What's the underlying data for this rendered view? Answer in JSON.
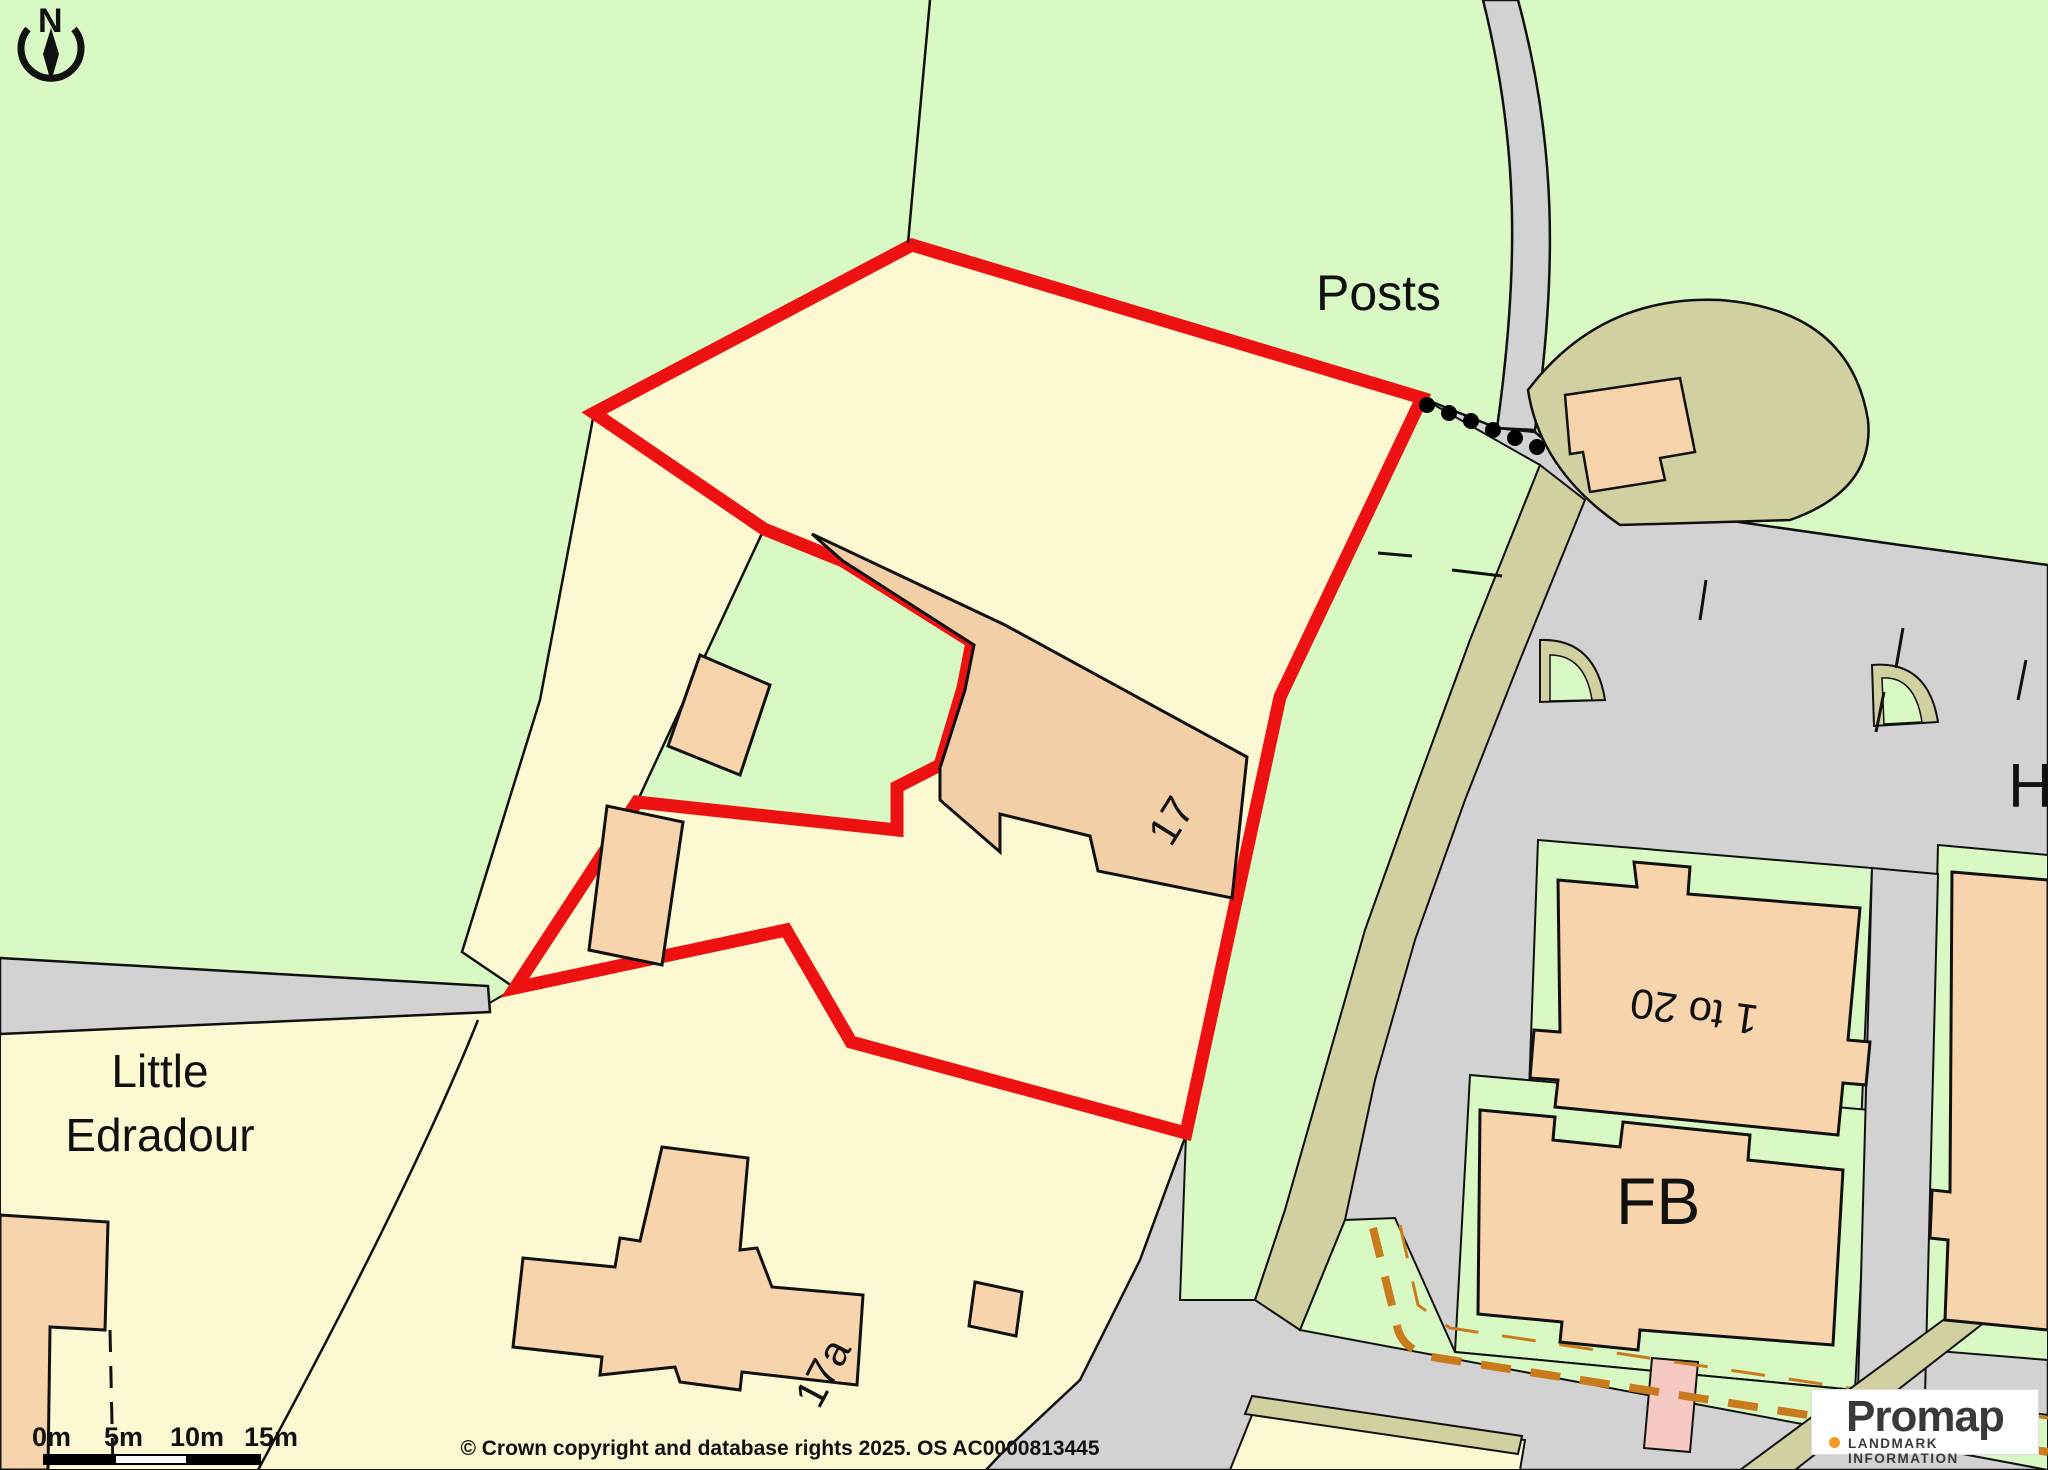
{
  "map": {
    "labels": {
      "posts": "Posts",
      "house_17": "17",
      "house_17a": "17a",
      "flats_range": "1 to 20",
      "fb": "FB",
      "street_partial": "H",
      "area_line1": "Little",
      "area_line2": "Edradour"
    },
    "compass": {
      "north": "N"
    },
    "scale_bar": {
      "ticks": [
        "0m",
        "5m",
        "10m",
        "15m"
      ]
    },
    "copyright": "© Crown copyright and database rights 2025. OS AC0000813445",
    "logo": {
      "brand": "Promap",
      "tagline": "LANDMARK INFORMATION"
    },
    "colors": {
      "field_green": "#d9f9c4",
      "parcel_yellow": "#fcf9d2",
      "building_peach": "#f7d4ab",
      "building_tan": "#f2cfa6",
      "verge_khaki": "#d0d0a0",
      "road_grey": "#d2d2d2",
      "boundary_red": "#ee1111",
      "path_pink": "#f7c9c3",
      "dash_orange": "#c97b1d",
      "logo_orange": "#f59a23"
    }
  }
}
